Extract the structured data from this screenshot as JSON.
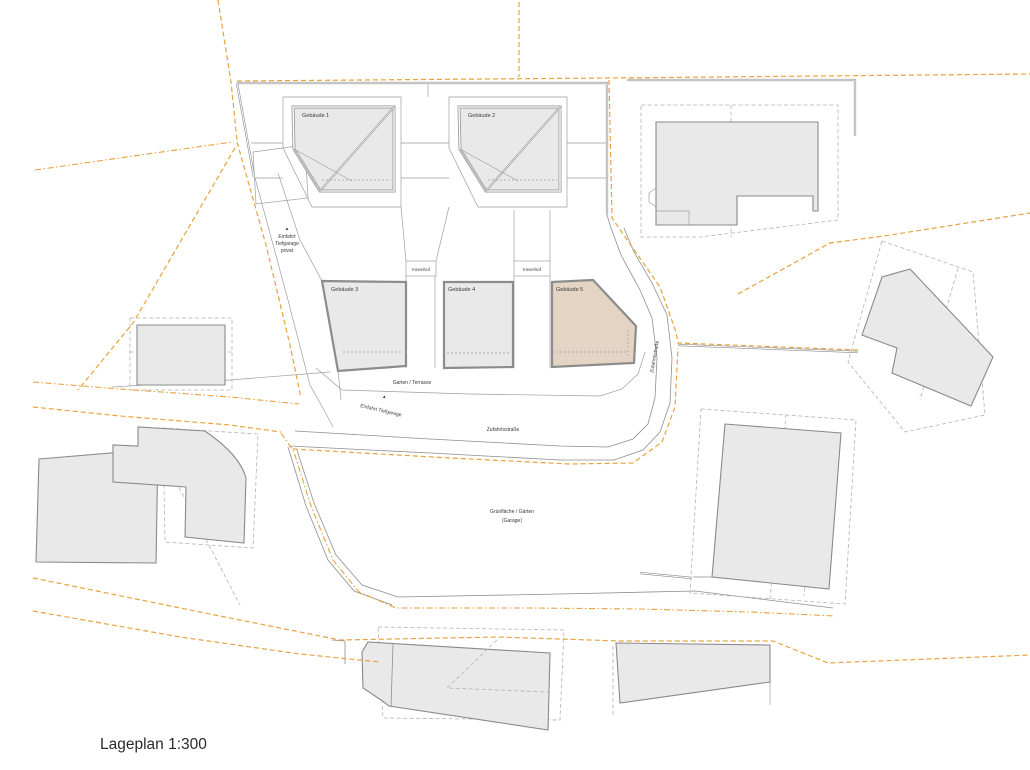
{
  "page": {
    "title": "Lageplan 1:300"
  },
  "buildings": {
    "gebaeude1": "Gebäude 1",
    "gebaeude2": "Gebäude 2",
    "gebaeude3": "Gebäude 3",
    "gebaeude4": "Gebäude 4",
    "gebaeude5": "Gebäude 5"
  },
  "courtyards": {
    "innenhof1": "Innenhof",
    "innenhof2": "Innenhof"
  },
  "areas": {
    "garten_terrasse": "Garten / Terrasse",
    "gruenflaeche_line1": "Grünfläche / Gärten",
    "gruenflaeche_line2": "(Garage)"
  },
  "roads": {
    "zufahrtsstrasse_main": "Zufahrtsstraße",
    "zufahrtsstrasse_side": "Zufahrtsstraße",
    "einfahrt_tiefgarage": "Einfahrt Tiefgarage"
  },
  "annotations": {
    "einfahrt_privat_line1": "Einfahrt",
    "einfahrt_privat_line2": "Tiefgarage",
    "einfahrt_privat_line3": "privat",
    "marker_triangle": "▲"
  },
  "colors": {
    "boundary_orange": "#E8A23E",
    "building_fill": "#E9E9E9",
    "building_highlight_fill": "#E3D4C3",
    "line_gray": "#8F8F8F"
  }
}
